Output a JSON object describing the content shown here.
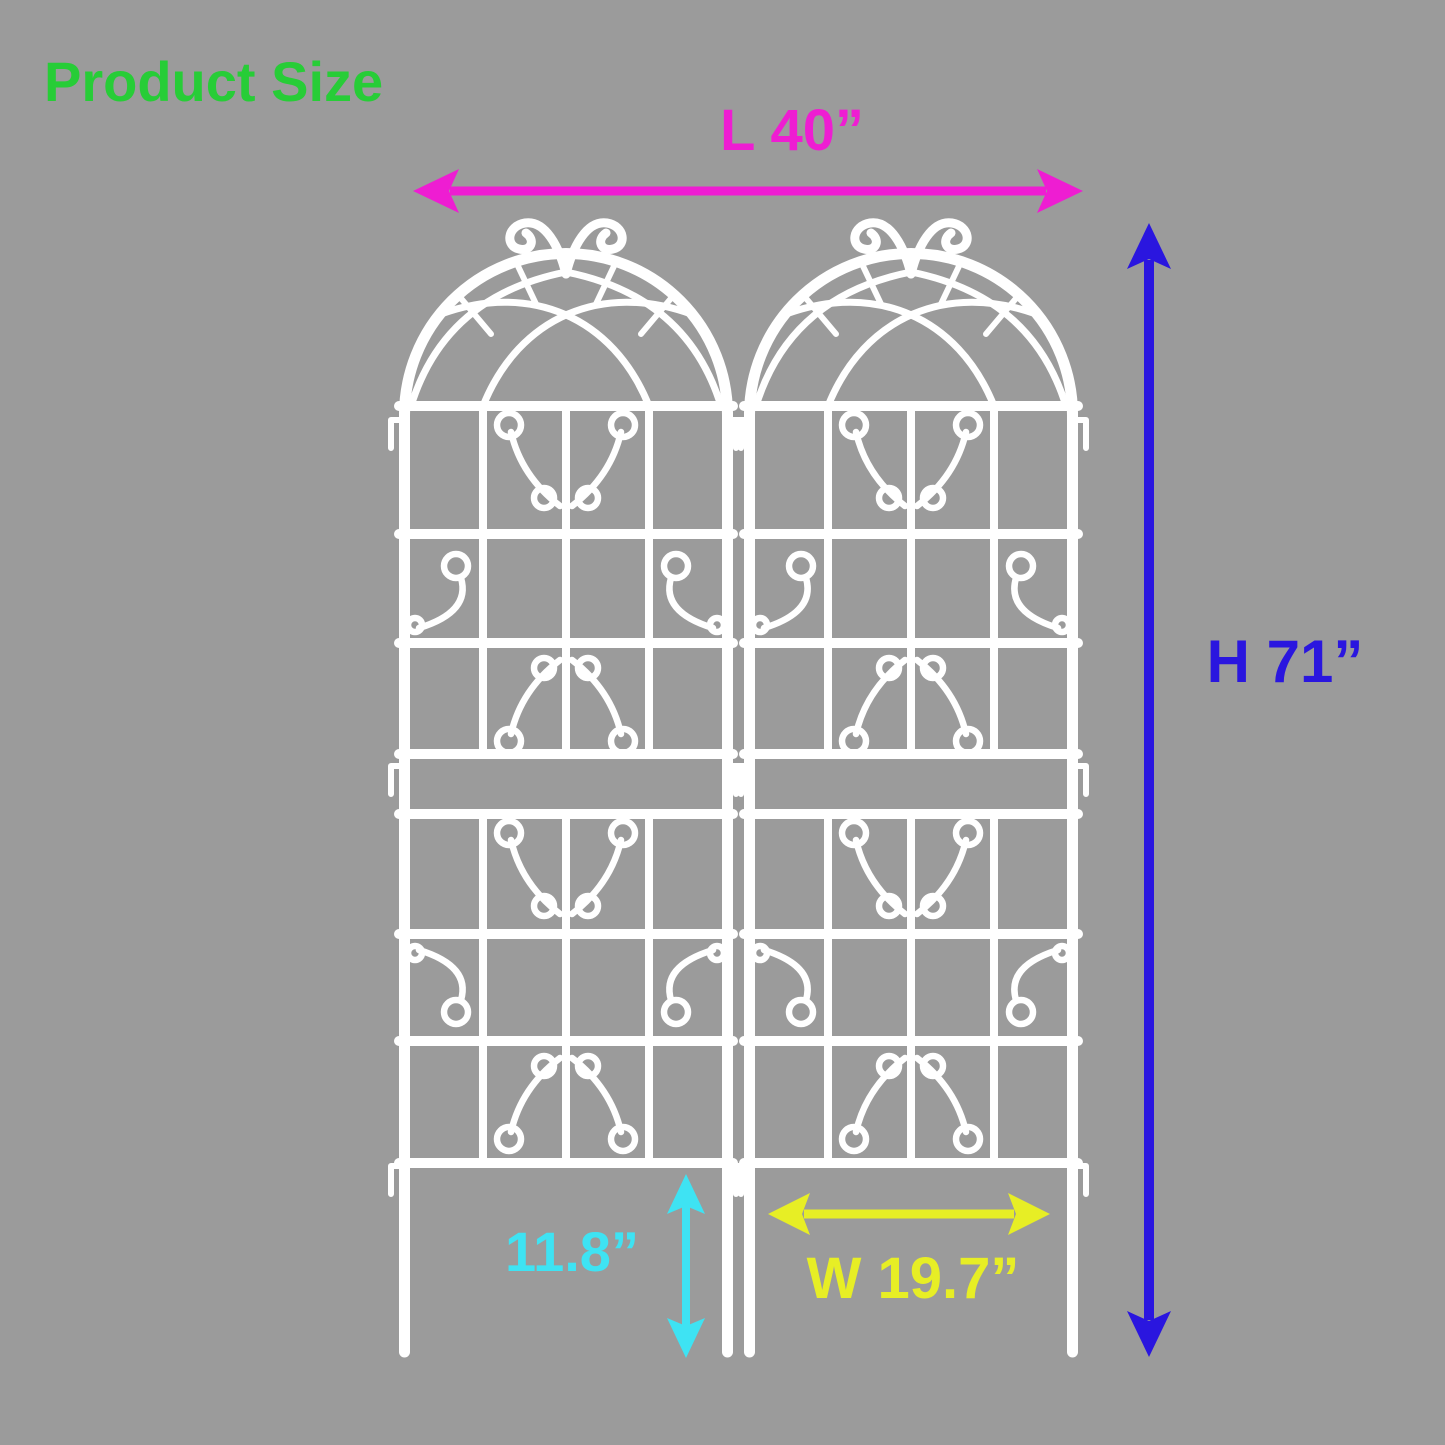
{
  "title": {
    "text": "Product Size"
  },
  "dimensions": {
    "length": {
      "label": "L 40”"
    },
    "height": {
      "label": "H 71”"
    },
    "leg_height": {
      "label": "11.8”"
    },
    "panel_width": {
      "label": "W 19.7”"
    }
  },
  "illustration": {
    "subject": "arched metal garden trellis panels",
    "panel_count": 2
  },
  "colors": {
    "background": "#9b9b9b",
    "title": "#27cd37",
    "length": "#ee1dd2",
    "height": "#2a16df",
    "leg_height": "#3ee3f3",
    "panel_width": "#e7ee25",
    "trellis": "#ffffff"
  }
}
